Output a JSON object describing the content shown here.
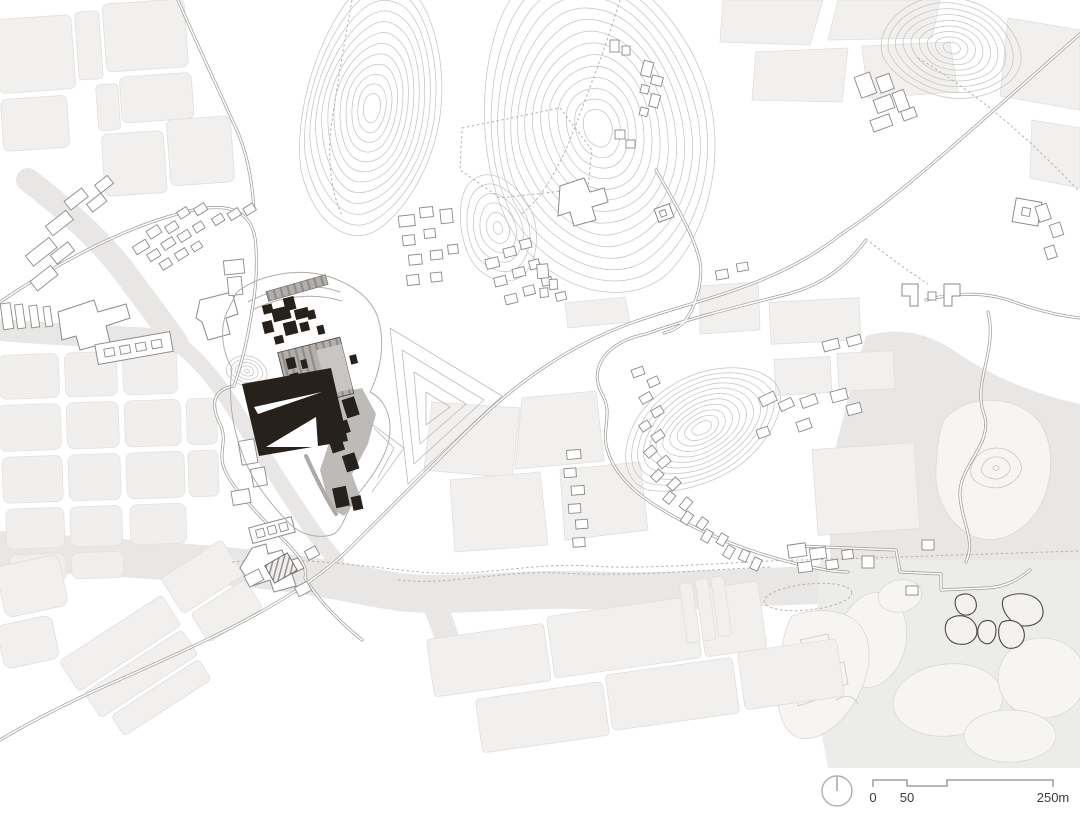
{
  "map": {
    "scale_bar": {
      "zero": "0",
      "fifty": "50",
      "max": "250m"
    },
    "icons": {
      "north_arrow": "north-arrow-icon"
    },
    "colors": {
      "background": "#ffffff",
      "building_black": "#27211b",
      "roof_gray": "#b2afac",
      "field_fill": "#f1f0ef",
      "water_fill": "#e8e7e6",
      "contour_stroke": "#c7c4c1",
      "road_stroke": "#9b9894",
      "outline_stroke": "#8d8a86",
      "label_text": "#3d3b39"
    }
  }
}
